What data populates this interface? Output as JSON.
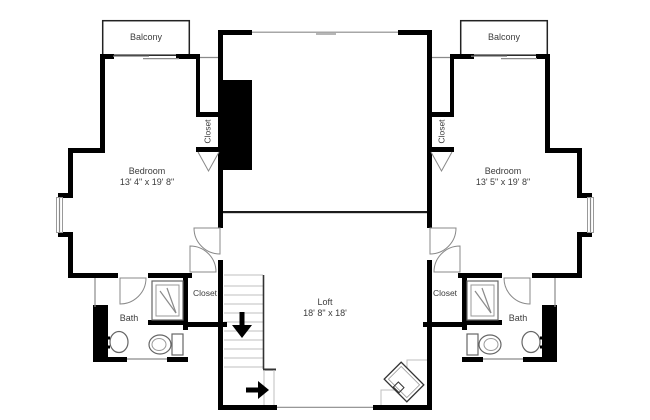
{
  "colors": {
    "wall": "#000000",
    "thin": "#8a8a8a",
    "light": "#bfbfbf",
    "text": "#3c3c3c",
    "bg": "#ffffff"
  },
  "rooms": {
    "balcony_left": {
      "label": "Balcony"
    },
    "balcony_right": {
      "label": "Balcony"
    },
    "bedroom_left": {
      "label": "Bedroom",
      "dims": "13' 4\" x 19' 8\""
    },
    "bedroom_right": {
      "label": "Bedroom",
      "dims": "13' 5\" x 19' 8\""
    },
    "loft": {
      "label": "Loft",
      "dims": "18' 8\" x 18'"
    },
    "bath_left": {
      "label": "Bath"
    },
    "bath_right": {
      "label": "Bath"
    },
    "closet_upper_left": {
      "label": "Closet"
    },
    "closet_upper_right": {
      "label": "Closet"
    },
    "closet_lower_left": {
      "label": "Closet"
    },
    "closet_lower_right": {
      "label": "Closet"
    }
  },
  "icons": {
    "stairs_direction_down": "arrow-down",
    "stairs_entry": "arrow-right"
  }
}
